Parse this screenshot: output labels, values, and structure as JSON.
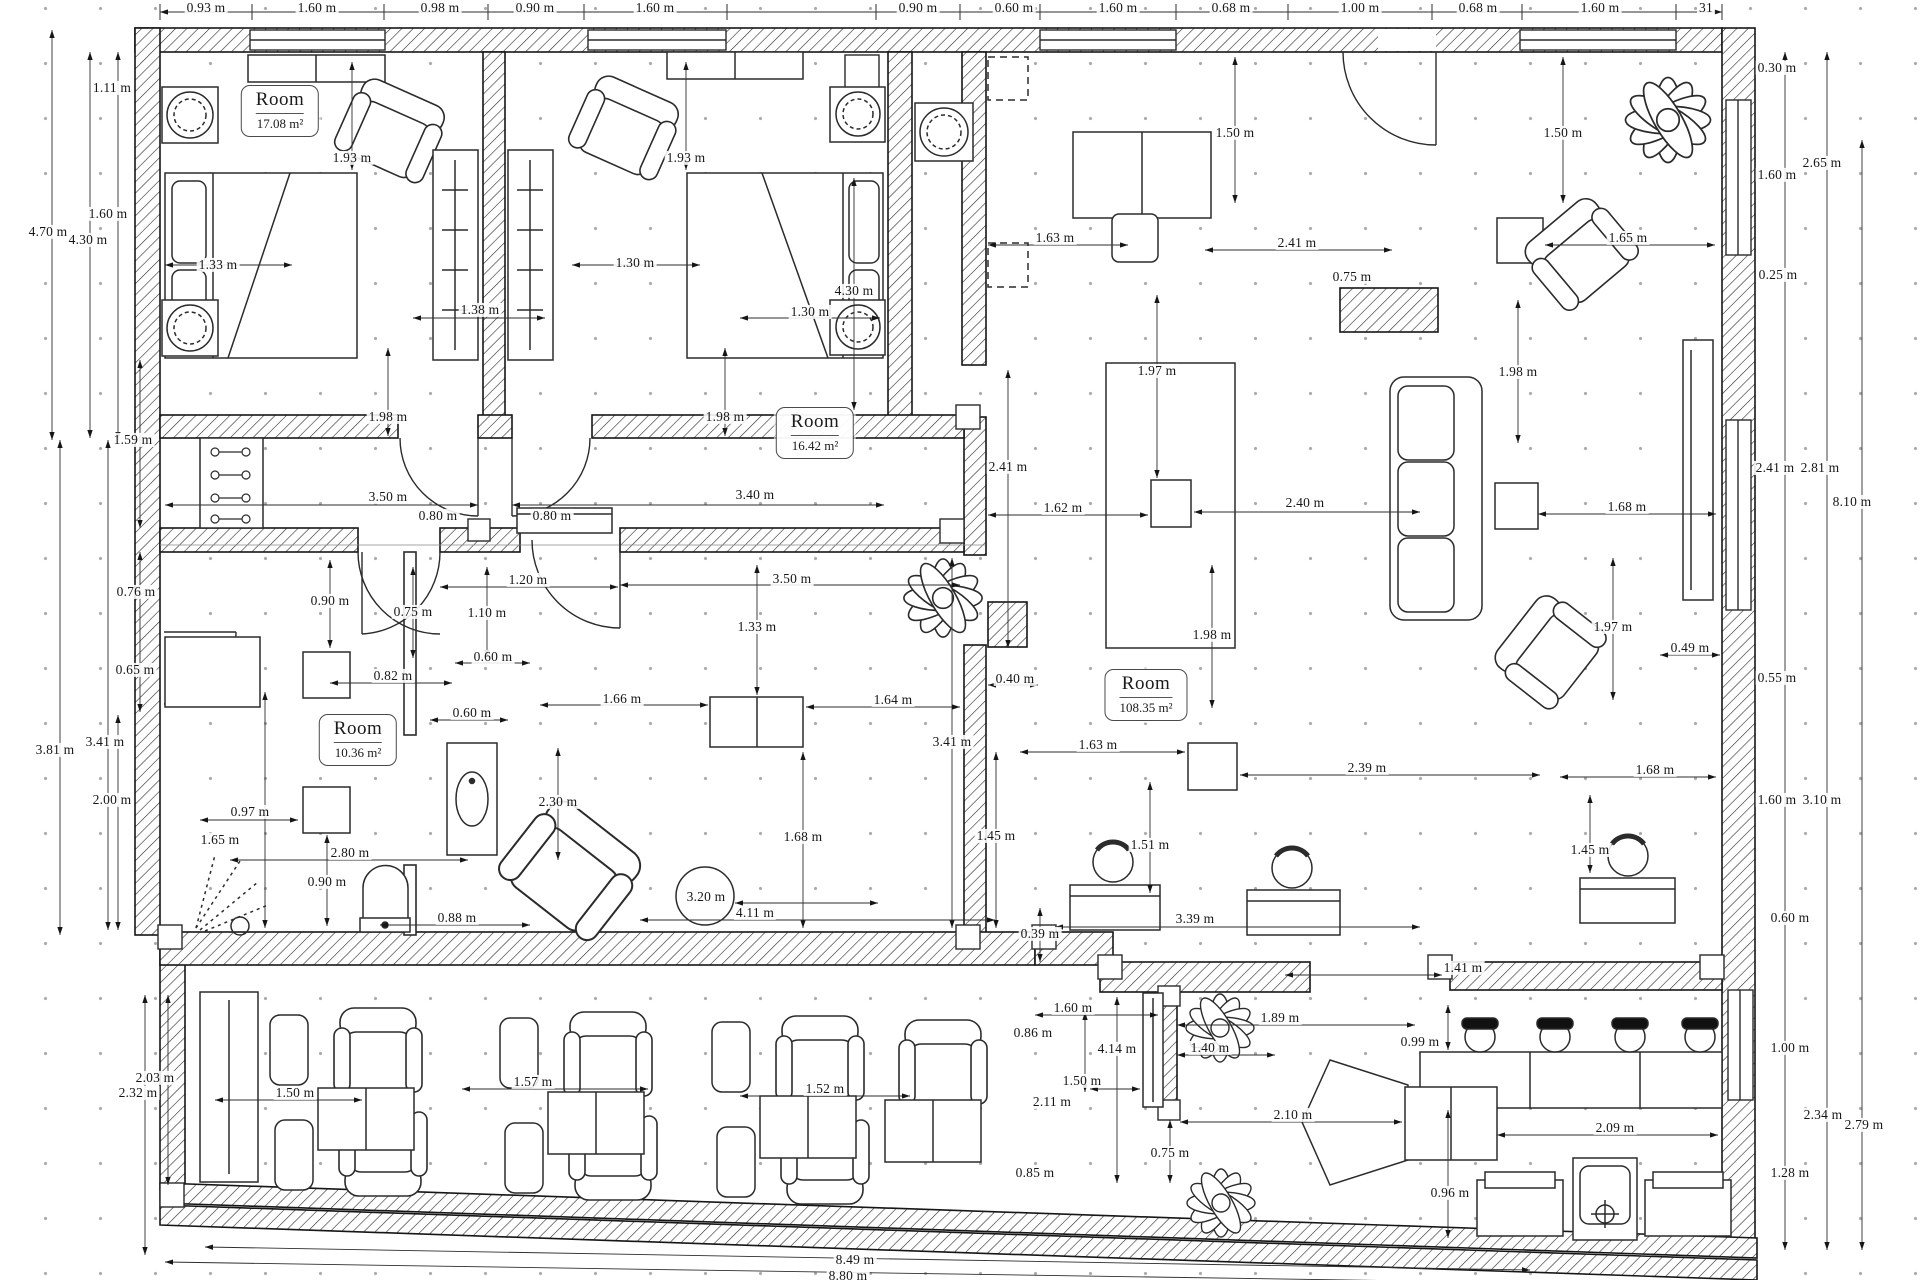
{
  "drawing": {
    "kind": "architectural floor plan",
    "units": "m"
  },
  "rooms": [
    {
      "label": "Room",
      "area": "17.08 m²",
      "x": 280,
      "y": 111
    },
    {
      "label": "Room",
      "area": "16.42 m²",
      "x": 815,
      "y": 433
    },
    {
      "label": "Room",
      "area": "108.35 m²",
      "x": 1146,
      "y": 695
    },
    {
      "label": "Room",
      "area": "10.36 m²",
      "x": 358,
      "y": 740
    }
  ],
  "dimensions": [
    [
      206,
      8,
      "0.93 m"
    ],
    [
      317,
      8,
      "1.60 m"
    ],
    [
      440,
      8,
      "0.98 m"
    ],
    [
      535,
      8,
      "0.90 m"
    ],
    [
      655,
      8,
      "1.60 m"
    ],
    [
      918,
      8,
      "0.90 m"
    ],
    [
      1014,
      8,
      "0.60 m"
    ],
    [
      1118,
      8,
      "1.60 m"
    ],
    [
      1231,
      8,
      "0.68 m"
    ],
    [
      1360,
      8,
      "1.00 m"
    ],
    [
      1478,
      8,
      "0.68 m"
    ],
    [
      1600,
      8,
      "1.60 m"
    ],
    [
      1706,
      8,
      "31"
    ],
    [
      112,
      88,
      "1.11 m"
    ],
    [
      48,
      232,
      "4.70 m"
    ],
    [
      88,
      240,
      "4.30 m"
    ],
    [
      108,
      214,
      "1.60 m"
    ],
    [
      133,
      440,
      "1.59 m"
    ],
    [
      136,
      592,
      "0.76 m"
    ],
    [
      135,
      670,
      "0.65 m"
    ],
    [
      55,
      750,
      "3.81 m"
    ],
    [
      105,
      742,
      "3.41 m"
    ],
    [
      112,
      800,
      "2.00 m"
    ],
    [
      155,
      1078,
      "2.03 m"
    ],
    [
      138,
      1093,
      "2.32 m"
    ],
    [
      1777,
      68,
      "0.30 m"
    ],
    [
      1822,
      163,
      "2.65 m"
    ],
    [
      1777,
      175,
      "1.60 m"
    ],
    [
      1778,
      275,
      "0.25 m"
    ],
    [
      1775,
      468,
      "2.41 m"
    ],
    [
      1820,
      468,
      "2.81 m"
    ],
    [
      1852,
      502,
      "8.10 m"
    ],
    [
      1690,
      648,
      "0.49 m"
    ],
    [
      1777,
      678,
      "0.55 m"
    ],
    [
      1777,
      800,
      "1.60 m"
    ],
    [
      1822,
      800,
      "3.10 m"
    ],
    [
      1790,
      918,
      "0.60 m"
    ],
    [
      1790,
      1048,
      "1.00 m"
    ],
    [
      1823,
      1115,
      "2.34 m"
    ],
    [
      1864,
      1125,
      "2.79 m"
    ],
    [
      1790,
      1173,
      "1.28 m"
    ],
    [
      352,
      158,
      "1.93 m"
    ],
    [
      218,
      265,
      "1.33 m"
    ],
    [
      480,
      310,
      "1.38 m"
    ],
    [
      388,
      417,
      "1.98 m"
    ],
    [
      388,
      497,
      "3.50 m"
    ],
    [
      438,
      516,
      "0.80 m"
    ],
    [
      686,
      158,
      "1.93 m"
    ],
    [
      635,
      263,
      "1.30 m"
    ],
    [
      854,
      291,
      "4.30 m"
    ],
    [
      810,
      312,
      "1.30 m"
    ],
    [
      725,
      417,
      "1.98 m"
    ],
    [
      755,
      495,
      "3.40 m"
    ],
    [
      552,
      516,
      "0.80 m"
    ],
    [
      528,
      580,
      "1.20 m"
    ],
    [
      330,
      601,
      "0.90 m"
    ],
    [
      413,
      612,
      "0.75 m"
    ],
    [
      487,
      613,
      "1.10 m"
    ],
    [
      792,
      579,
      "3.50 m"
    ],
    [
      757,
      627,
      "1.33 m"
    ],
    [
      493,
      657,
      "0.60 m"
    ],
    [
      393,
      676,
      "0.82 m"
    ],
    [
      472,
      713,
      "0.60 m"
    ],
    [
      622,
      699,
      "1.66 m"
    ],
    [
      893,
      700,
      "1.64 m"
    ],
    [
      250,
      812,
      "0.97 m"
    ],
    [
      220,
      840,
      "1.65 m"
    ],
    [
      350,
      853,
      "2.80 m"
    ],
    [
      327,
      882,
      "0.90 m"
    ],
    [
      457,
      918,
      "0.88 m"
    ],
    [
      558,
      802,
      "2.30 m"
    ],
    [
      706,
      897,
      "3.20 m"
    ],
    [
      755,
      913,
      "4.11 m"
    ],
    [
      803,
      837,
      "1.68 m"
    ],
    [
      952,
      742,
      "3.41 m"
    ],
    [
      1015,
      679,
      "0.40 m"
    ],
    [
      996,
      836,
      "1.45 m"
    ],
    [
      1235,
      133,
      "1.50 m"
    ],
    [
      1563,
      133,
      "1.50 m"
    ],
    [
      1055,
      238,
      "1.63 m"
    ],
    [
      1297,
      243,
      "2.41 m"
    ],
    [
      1352,
      277,
      "0.75 m"
    ],
    [
      1628,
      238,
      "1.65 m"
    ],
    [
      1157,
      371,
      "1.97 m"
    ],
    [
      1008,
      467,
      "2.41 m"
    ],
    [
      1063,
      508,
      "1.62 m"
    ],
    [
      1305,
      503,
      "2.40 m"
    ],
    [
      1627,
      507,
      "1.68 m"
    ],
    [
      1518,
      372,
      "1.98 m"
    ],
    [
      1212,
      635,
      "1.98 m"
    ],
    [
      1613,
      627,
      "1.97 m"
    ],
    [
      1098,
      745,
      "1.63 m"
    ],
    [
      1367,
      768,
      "2.39 m"
    ],
    [
      1655,
      770,
      "1.68 m"
    ],
    [
      1150,
      845,
      "1.51 m"
    ],
    [
      1195,
      919,
      "3.39 m"
    ],
    [
      1590,
      850,
      "1.45 m"
    ],
    [
      1463,
      968,
      "1.41 m"
    ],
    [
      1040,
      934,
      "0.39 m"
    ],
    [
      1073,
      1008,
      "1.60 m"
    ],
    [
      1033,
      1033,
      "0.86 m"
    ],
    [
      1117,
      1049,
      "4.14 m"
    ],
    [
      1082,
      1081,
      "1.50 m"
    ],
    [
      1052,
      1102,
      "2.11 m"
    ],
    [
      1035,
      1173,
      "0.85 m"
    ],
    [
      1170,
      1153,
      "0.75 m"
    ],
    [
      1210,
      1048,
      "1.40 m"
    ],
    [
      1280,
      1018,
      "1.89 m"
    ],
    [
      1420,
      1042,
      "0.99 m"
    ],
    [
      1293,
      1115,
      "2.10 m"
    ],
    [
      1615,
      1128,
      "2.09 m"
    ],
    [
      1450,
      1193,
      "0.96 m"
    ],
    [
      295,
      1093,
      "1.50 m"
    ],
    [
      533,
      1082,
      "1.57 m"
    ],
    [
      825,
      1089,
      "1.52 m"
    ],
    [
      855,
      1260,
      "8.49 m"
    ],
    [
      848,
      1276,
      "8.80 m"
    ]
  ]
}
